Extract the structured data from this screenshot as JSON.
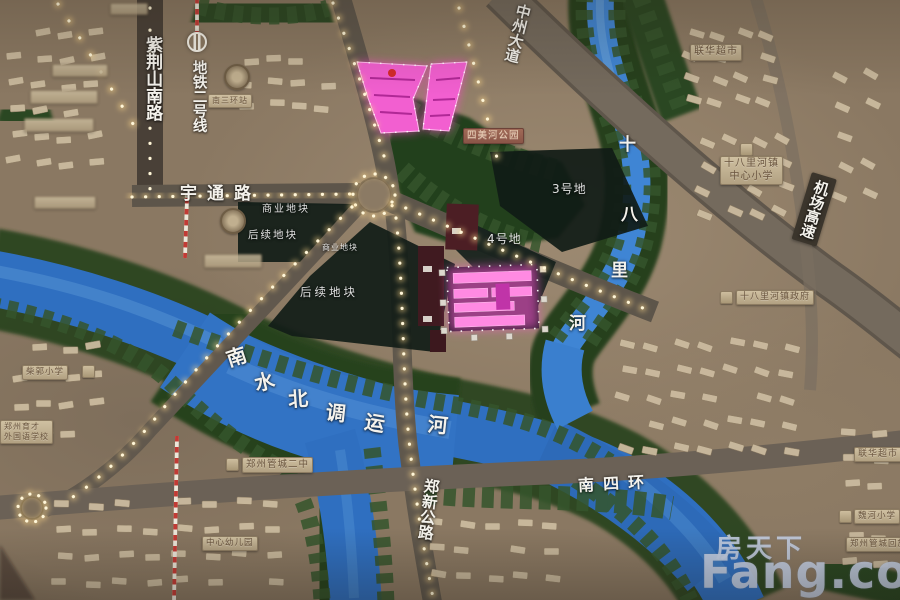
{
  "watermark": {
    "cn": "房天下",
    "en": "Fang.com"
  },
  "roads": {
    "zijinshan_south": "紫荆山南路",
    "metro_line2": "地铁二号线",
    "metro_station": "南三环站",
    "yutong": "宇通路",
    "zhongzhou_avenue": "中州大道",
    "airport_expressway": "机场高速",
    "south_4th_ring": "南四环",
    "zhengxin_highway": "郑新公路"
  },
  "rivers": {
    "shibalihe": [
      "十",
      "八",
      "里",
      "河"
    ],
    "nanshuibeidiao": [
      "南",
      "水",
      "北",
      "调",
      "运",
      "河"
    ]
  },
  "plots": {
    "commercial_1": "商业地块",
    "future_1": "后续地块",
    "commercial_2": "商业地块",
    "future_2": "后续地块",
    "plot_3": "3号地",
    "plot_4": "4号地"
  },
  "pois": {
    "lianhua_supermarket_top": "联华超市",
    "river_park": "四美河公园",
    "center_primary_line1": "十八里河镇",
    "center_primary_line2": "中心小学",
    "town_government": "十八里河镇政府",
    "chaiguo_primary": "柴郭小学",
    "yucai_line1": "郑州育才",
    "yucai_line2": "外国语学校",
    "guancheng_no2_middle": "郑州管城二中",
    "kindergarten": "中心幼儿园",
    "lianhua_supermarket_right": "联华超市",
    "weihe_primary": "魏河小学",
    "guancheng_district": "郑州管城回族"
  }
}
